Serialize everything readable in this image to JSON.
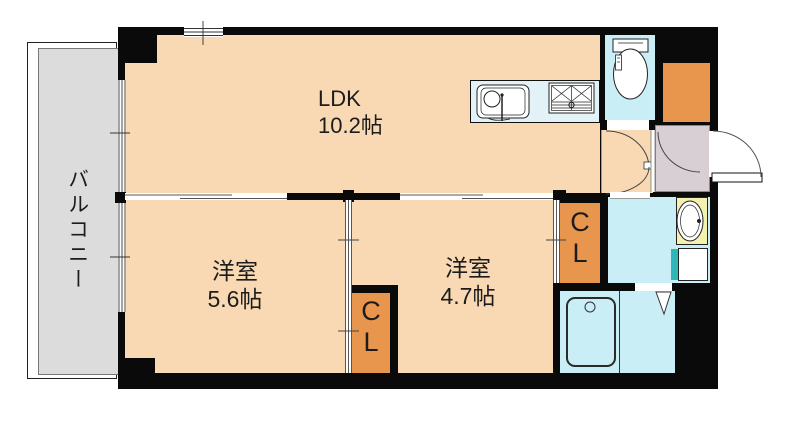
{
  "rooms": {
    "balcony": {
      "name": "バルコニー"
    },
    "ldk": {
      "name": "LDK",
      "area": "10.2帖"
    },
    "bedroom_west": {
      "name": "洋室",
      "area": "5.6帖"
    },
    "bedroom_east": {
      "name": "洋室",
      "area": "4.7帖"
    },
    "closet_center": {
      "line1": "C",
      "line2": "L"
    },
    "closet_right": {
      "line1": "C",
      "line2": "L"
    }
  },
  "colors": {
    "wall": "#0a0a0a",
    "floor": "#f8d9b3",
    "closet": "#e8954e",
    "wet": "#c9eef5",
    "counter": "#e2f2f7",
    "basin": "#f4f0b0",
    "washer": "#2fb7b7",
    "balcony": "#dcdcdc",
    "entrance": "#d7cfd3",
    "text": "#1c1c1c"
  }
}
